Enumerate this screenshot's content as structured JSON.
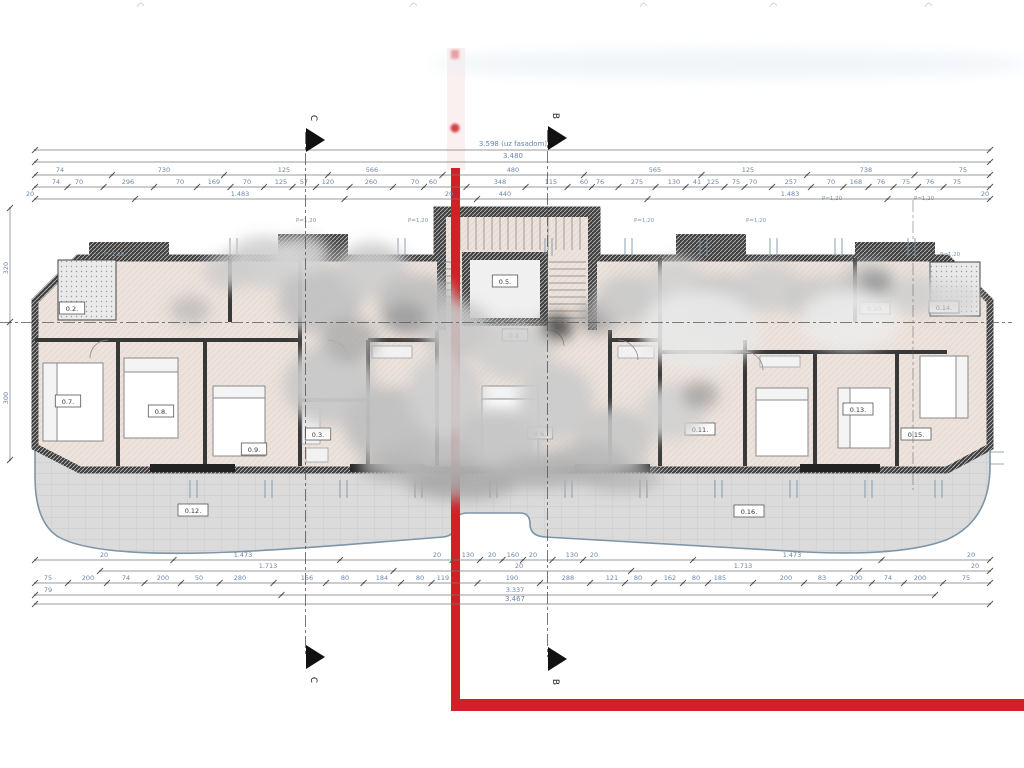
{
  "drawing_type": "architectural floor plan",
  "sections": {
    "c": "C",
    "b": "B"
  },
  "red_boundary": {
    "color": "#cf2128"
  },
  "dim_rows_top": [
    {
      "y": 146,
      "line_y": 150,
      "x0": 35,
      "x1": 990,
      "cls": "dimtot",
      "labels": [
        {
          "t": "3.598 (uz fasadom)",
          "x": 513
        }
      ]
    },
    {
      "y": 158,
      "line_y": 162,
      "x0": 35,
      "x1": 990,
      "cls": "dimtot",
      "labels": [
        {
          "t": "3.480",
          "x": 513
        }
      ]
    },
    {
      "y": 172,
      "line_y": 175,
      "x0": 35,
      "x1": 990,
      "cls": "dimtxt",
      "labels": [
        {
          "t": "74",
          "x": 60
        },
        {
          "t": "730",
          "x": 164
        },
        {
          "t": "125",
          "x": 284
        },
        {
          "t": "566",
          "x": 372
        },
        {
          "t": "480",
          "x": 513
        },
        {
          "t": "565",
          "x": 655
        },
        {
          "t": "125",
          "x": 748
        },
        {
          "t": "738",
          "x": 866
        },
        {
          "t": "75",
          "x": 963
        }
      ]
    },
    {
      "y": 184,
      "line_y": 187,
      "x0": 35,
      "x1": 990,
      "cls": "dimtxt",
      "labels": [
        {
          "t": "74",
          "x": 56
        },
        {
          "t": "70",
          "x": 79
        },
        {
          "t": "296",
          "x": 128
        },
        {
          "t": "70",
          "x": 180
        },
        {
          "t": "169",
          "x": 214
        },
        {
          "t": "70",
          "x": 247
        },
        {
          "t": "125",
          "x": 281
        },
        {
          "t": "57",
          "x": 304
        },
        {
          "t": "120",
          "x": 328
        },
        {
          "t": "260",
          "x": 371
        },
        {
          "t": "70",
          "x": 415
        },
        {
          "t": "60",
          "x": 433
        },
        {
          "t": "348",
          "x": 500
        },
        {
          "t": "115",
          "x": 551
        },
        {
          "t": "60",
          "x": 584
        },
        {
          "t": "76",
          "x": 600
        },
        {
          "t": "275",
          "x": 637
        },
        {
          "t": "130",
          "x": 674
        },
        {
          "t": "41",
          "x": 697
        },
        {
          "t": "125",
          "x": 713
        },
        {
          "t": "75",
          "x": 736
        },
        {
          "t": "70",
          "x": 753
        },
        {
          "t": "257",
          "x": 791
        },
        {
          "t": "70",
          "x": 831
        },
        {
          "t": "168",
          "x": 856
        },
        {
          "t": "76",
          "x": 881
        },
        {
          "t": "75",
          "x": 906
        },
        {
          "t": "76",
          "x": 930
        },
        {
          "t": "75",
          "x": 957
        }
      ]
    },
    {
      "y": 196,
      "line_y": 199,
      "x0": 35,
      "x1": 990,
      "cls": "dimtxt",
      "labels": [
        {
          "t": "20",
          "x": 30
        },
        {
          "t": "1.483",
          "x": 240
        },
        {
          "t": "20",
          "x": 449
        },
        {
          "t": "440",
          "x": 505
        },
        {
          "t": "1.483",
          "x": 790
        },
        {
          "t": "20",
          "x": 985
        }
      ]
    }
  ],
  "dim_rows_bottom": [
    {
      "y": 557,
      "line_y": 560,
      "x0": 35,
      "x1": 990,
      "cls": "dimtxt",
      "labels": [
        {
          "t": "20",
          "x": 104
        },
        {
          "t": "1.473",
          "x": 243
        },
        {
          "t": "20",
          "x": 437
        },
        {
          "t": "130",
          "x": 468
        },
        {
          "t": "20",
          "x": 492
        },
        {
          "t": "160",
          "x": 513
        },
        {
          "t": "20",
          "x": 533
        },
        {
          "t": "130",
          "x": 572
        },
        {
          "t": "20",
          "x": 594
        },
        {
          "t": "1.473",
          "x": 792
        },
        {
          "t": "20",
          "x": 971
        }
      ]
    },
    {
      "y": 568,
      "line_y": 571,
      "x0": 100,
      "x1": 990,
      "cls": "dimtxt",
      "labels": [
        {
          "t": "1.713",
          "x": 268
        },
        {
          "t": "20",
          "x": 519
        },
        {
          "t": "1.713",
          "x": 743
        },
        {
          "t": "20",
          "x": 975
        }
      ]
    },
    {
      "y": 580,
      "line_y": 583,
      "x0": 35,
      "x1": 990,
      "cls": "dimtxt",
      "labels": [
        {
          "t": "75",
          "x": 48
        },
        {
          "t": "200",
          "x": 88
        },
        {
          "t": "74",
          "x": 126
        },
        {
          "t": "200",
          "x": 163
        },
        {
          "t": "50",
          "x": 199
        },
        {
          "t": "280",
          "x": 240
        },
        {
          "t": "156",
          "x": 307
        },
        {
          "t": "80",
          "x": 345
        },
        {
          "t": "184",
          "x": 382
        },
        {
          "t": "80",
          "x": 420
        },
        {
          "t": "119",
          "x": 443
        },
        {
          "t": "190",
          "x": 512
        },
        {
          "t": "288",
          "x": 568
        },
        {
          "t": "121",
          "x": 612
        },
        {
          "t": "80",
          "x": 638
        },
        {
          "t": "162",
          "x": 670
        },
        {
          "t": "80",
          "x": 696
        },
        {
          "t": "185",
          "x": 720
        },
        {
          "t": "200",
          "x": 786
        },
        {
          "t": "83",
          "x": 822
        },
        {
          "t": "200",
          "x": 856
        },
        {
          "t": "74",
          "x": 888
        },
        {
          "t": "200",
          "x": 920
        },
        {
          "t": "75",
          "x": 966
        }
      ]
    },
    {
      "y": 592,
      "line_y": 595,
      "x0": 35,
      "x1": 935,
      "cls": "dimtxt",
      "labels": [
        {
          "t": "79",
          "x": 48
        },
        {
          "t": "3.337",
          "x": 515
        }
      ]
    },
    {
      "y": 601,
      "line_y": 604,
      "x0": 35,
      "x1": 990,
      "cls": "dimtot",
      "labels": [
        {
          "t": "3.467",
          "x": 515
        }
      ]
    }
  ],
  "dims_left": {
    "x": 10,
    "y0": 208,
    "y1": 460,
    "labels": [
      {
        "t": "320",
        "y": 268
      },
      {
        "t": "300",
        "y": 398
      }
    ]
  },
  "room_labels": [
    {
      "t": "0.2.",
      "x": 72,
      "y": 311
    },
    {
      "t": "0.7.",
      "x": 68,
      "y": 404
    },
    {
      "t": "0.8.",
      "x": 161,
      "y": 414
    },
    {
      "t": "0.9.",
      "x": 254,
      "y": 452
    },
    {
      "t": "0.3.",
      "x": 318,
      "y": 437
    },
    {
      "t": "0.5.",
      "x": 505,
      "y": 284
    },
    {
      "t": "0.4.",
      "x": 515,
      "y": 338
    },
    {
      "t": "0.6.",
      "x": 540,
      "y": 436
    },
    {
      "t": "0.10.",
      "x": 875,
      "y": 311
    },
    {
      "t": "0.14.",
      "x": 944,
      "y": 310
    },
    {
      "t": "0.13.",
      "x": 858,
      "y": 412
    },
    {
      "t": "0.15.",
      "x": 916,
      "y": 437
    },
    {
      "t": "0.11.",
      "x": 700,
      "y": 432
    },
    {
      "t": "0.12.",
      "x": 193,
      "y": 513
    },
    {
      "t": "0.16.",
      "x": 749,
      "y": 514
    }
  ],
  "parapet_labels": [
    {
      "t": "P=1,20",
      "x": 104,
      "y": 256
    },
    {
      "t": "P=1,20",
      "x": 296,
      "y": 222
    },
    {
      "t": "P=1,20",
      "x": 408,
      "y": 222
    },
    {
      "t": "P=1,20",
      "x": 634,
      "y": 222
    },
    {
      "t": "P=1,20",
      "x": 746,
      "y": 222
    },
    {
      "t": "P=1,20",
      "x": 822,
      "y": 200
    },
    {
      "t": "P=1,20",
      "x": 914,
      "y": 200
    },
    {
      "t": "P=1,20",
      "x": 940,
      "y": 256
    }
  ],
  "window_marks": {
    "top": [
      230,
      398,
      545,
      625,
      700,
      770,
      835,
      908
    ],
    "bottom": [
      190,
      265,
      340,
      415,
      490,
      565,
      640,
      715,
      790,
      865,
      935
    ]
  },
  "top_edge_marks": [
    137,
    410,
    640,
    770,
    925
  ],
  "obscured_regions": [
    [
      265,
      262,
      38,
      26,
      "#cfcfcf",
      0.9
    ],
    [
      320,
      300,
      42,
      34,
      "#c2c2c2",
      0.95
    ],
    [
      372,
      270,
      36,
      28,
      "#cccccc",
      0.9
    ],
    [
      418,
      305,
      40,
      30,
      "#bdbdbd",
      0.9
    ],
    [
      300,
      255,
      30,
      20,
      "#d5d5d5",
      0.9
    ],
    [
      458,
      330,
      35,
      28,
      "#c6c6c6",
      0.9
    ],
    [
      515,
      350,
      40,
      30,
      "#cdcdcd",
      0.9
    ],
    [
      557,
      327,
      16,
      13,
      "#3a3a3a",
      0.85
    ],
    [
      597,
      318,
      20,
      16,
      "#9a9a9a",
      0.8
    ],
    [
      630,
      300,
      34,
      26,
      "#c9c9c9",
      0.9
    ],
    [
      676,
      282,
      30,
      24,
      "#d2d2d2",
      0.9
    ],
    [
      722,
      300,
      36,
      26,
      "#c6c6c6",
      0.9
    ],
    [
      770,
      288,
      34,
      24,
      "#cdcdcd",
      0.9
    ],
    [
      820,
      300,
      34,
      24,
      "#c9c9c9",
      0.85
    ],
    [
      868,
      285,
      30,
      22,
      "#c2c2c2",
      0.85
    ],
    [
      875,
      283,
      16,
      12,
      "#8a8a8a",
      0.7
    ],
    [
      915,
      295,
      28,
      20,
      "#cfcfcf",
      0.85
    ],
    [
      955,
      300,
      24,
      18,
      "#d6d6d6",
      0.8
    ],
    [
      190,
      310,
      20,
      14,
      "#b5b5b5",
      0.7
    ],
    [
      228,
      272,
      24,
      18,
      "#cccccc",
      0.8
    ],
    [
      330,
      385,
      46,
      40,
      "#c8c8c8",
      0.95
    ],
    [
      388,
      425,
      44,
      38,
      "#c0c0c0",
      0.95
    ],
    [
      445,
      395,
      38,
      42,
      "#cfcfcf",
      0.95
    ],
    [
      498,
      442,
      44,
      34,
      "#c4c4c4",
      0.95
    ],
    [
      556,
      402,
      38,
      38,
      "#cbcbcb",
      0.95
    ],
    [
      614,
      440,
      38,
      32,
      "#c6c6c6",
      0.9
    ],
    [
      672,
      412,
      32,
      28,
      "#d0d0d0",
      0.9
    ],
    [
      430,
      462,
      48,
      26,
      "#bdbdbd",
      0.9
    ],
    [
      520,
      468,
      44,
      22,
      "#c6c6c6",
      0.9
    ],
    [
      585,
      462,
      40,
      20,
      "#b8b8b8",
      0.85
    ],
    [
      350,
      340,
      28,
      22,
      "#ababab",
      0.8
    ],
    [
      405,
      318,
      22,
      16,
      "#9b9b9b",
      0.8
    ],
    [
      700,
      395,
      18,
      14,
      "#999999",
      0.7
    ],
    [
      700,
      330,
      60,
      40,
      "#e8e8e8",
      0.9
    ],
    [
      850,
      320,
      50,
      30,
      "#ececec",
      0.85
    ],
    [
      462,
      482,
      56,
      18,
      "#a8a8a8",
      0.85
    ],
    [
      545,
      472,
      48,
      16,
      "#b0b0b0",
      0.85
    ],
    [
      395,
      468,
      36,
      14,
      "#b4b4b4",
      0.8
    ],
    [
      620,
      478,
      40,
      14,
      "#aeaeae",
      0.7
    ],
    [
      730,
      64,
      300,
      15,
      "#e4eef5",
      0.5
    ]
  ]
}
